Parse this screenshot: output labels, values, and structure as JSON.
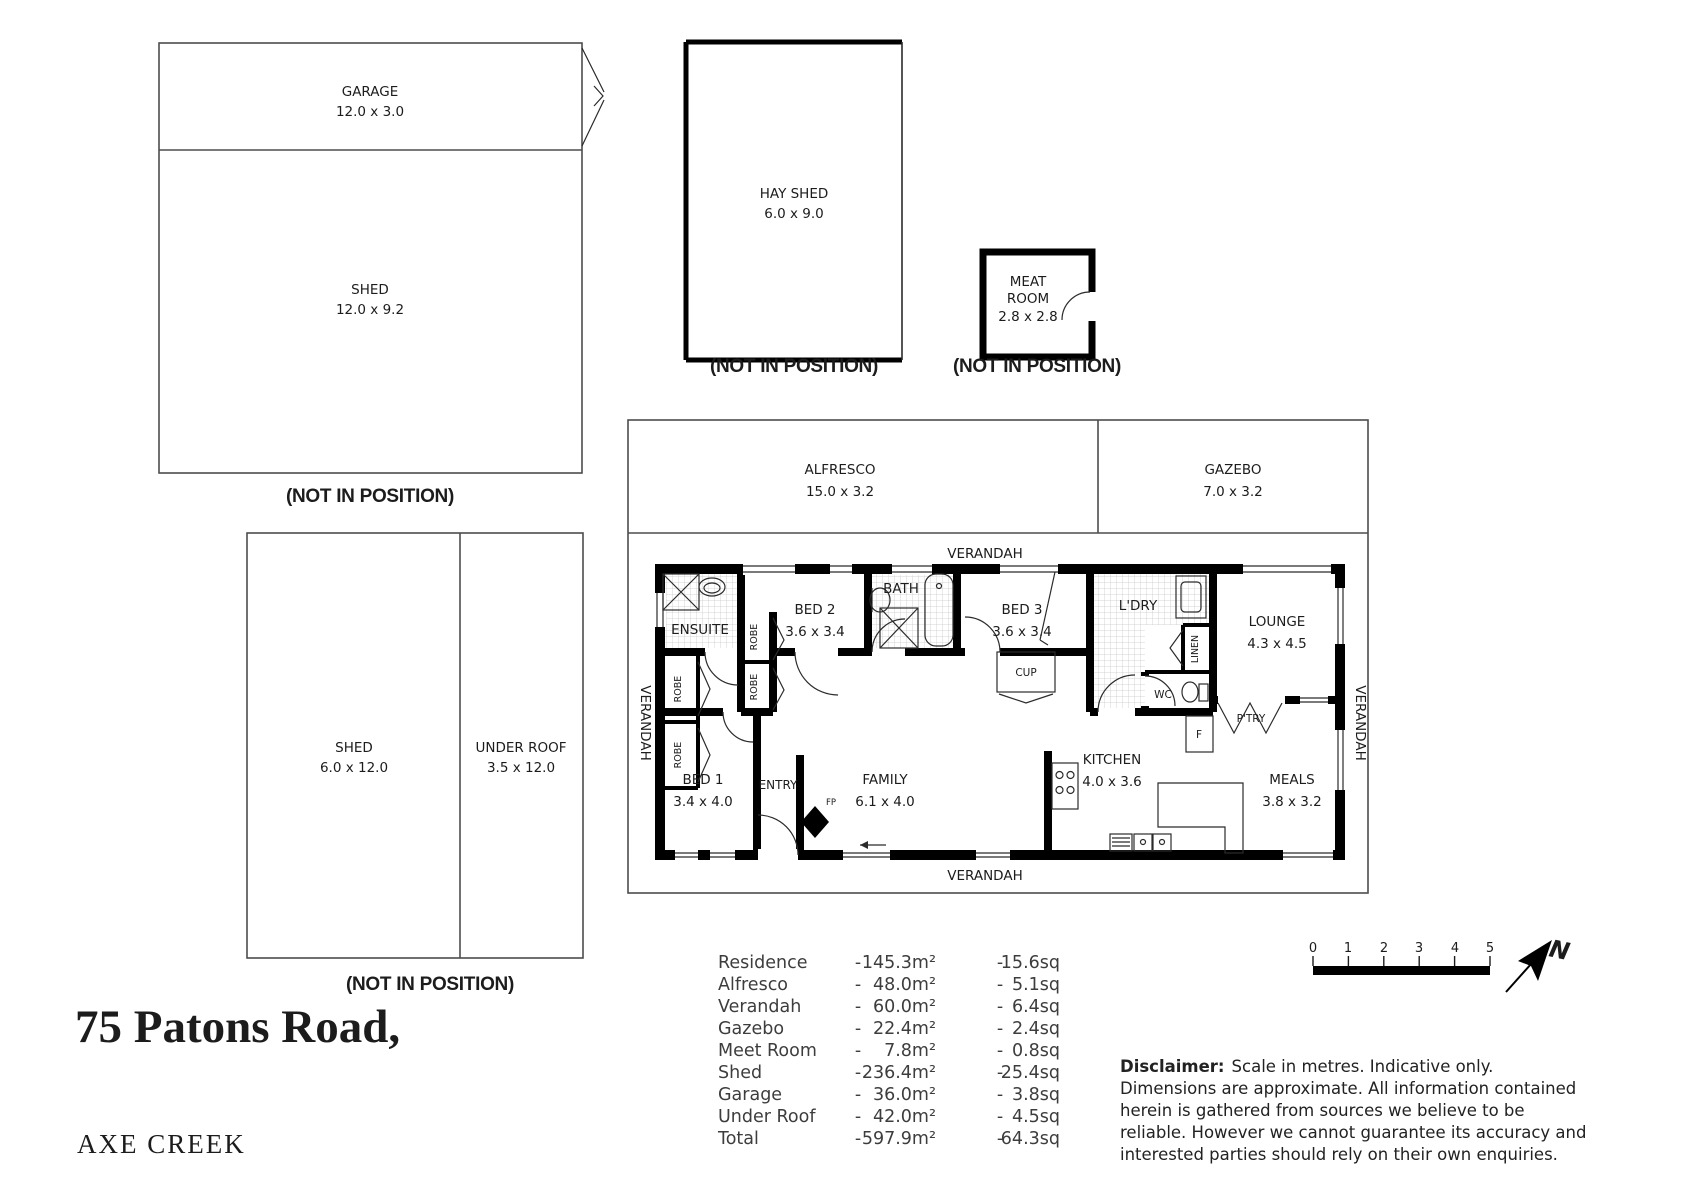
{
  "title": {
    "street": "75 Patons Road,",
    "suburb": "AXE CREEK"
  },
  "not_in_position": "(NOT IN POSITION)",
  "outbuildings": {
    "garage": {
      "name": "GARAGE",
      "dims": "12.0 x 3.0"
    },
    "shed_large": {
      "name": "SHED",
      "dims": "12.0 x 9.2"
    },
    "hay_shed": {
      "name": "HAY SHED",
      "dims": "6.0 x 9.0"
    },
    "meat_room": {
      "name_line1": "MEAT",
      "name_line2": "ROOM",
      "dims": "2.8 x 2.8"
    },
    "shed_small": {
      "name": "SHED",
      "dims": "6.0 x 12.0"
    },
    "under_roof": {
      "name": "UNDER ROOF",
      "dims": "3.5 x 12.0"
    }
  },
  "plan": {
    "alfresco": {
      "name": "ALFRESCO",
      "dims": "15.0 x 3.2"
    },
    "gazebo": {
      "name": "GAZEBO",
      "dims": "7.0 x 3.2"
    },
    "verandah": "VERANDAH",
    "rooms": {
      "ensuite": {
        "name": "ENSUITE"
      },
      "bed2": {
        "name": "BED 2",
        "dims": "3.6 x 3.4"
      },
      "bath": {
        "name": "BATH"
      },
      "bed3": {
        "name": "BED 3",
        "dims": "3.6 x 3.4"
      },
      "ldry": {
        "name": "L'DRY"
      },
      "lounge": {
        "name": "LOUNGE",
        "dims": "4.3 x 4.5"
      },
      "bed1": {
        "name": "BED 1",
        "dims": "3.4 x 4.0"
      },
      "entry": {
        "name": "ENTRY"
      },
      "family": {
        "name": "FAMILY",
        "dims": "6.1 x 4.0"
      },
      "kitchen": {
        "name": "KITCHEN",
        "dims": "4.0 x 3.6"
      },
      "meals": {
        "name": "MEALS",
        "dims": "3.8 x 3.2"
      }
    },
    "fixtures": {
      "robe": "ROBE",
      "linen": "LINEN",
      "wc": "WC",
      "cup": "CUP",
      "fridge": "F",
      "pantry": "P'TRY",
      "fireplace": "FP"
    }
  },
  "areas": {
    "dash": "-",
    "rows": [
      {
        "name": "Residence",
        "m2": "145.3m²",
        "sq": "15.6sq"
      },
      {
        "name": "Alfresco",
        "m2": "48.0m²",
        "sq": "5.1sq"
      },
      {
        "name": "Verandah",
        "m2": "60.0m²",
        "sq": "6.4sq"
      },
      {
        "name": "Gazebo",
        "m2": "22.4m²",
        "sq": "2.4sq"
      },
      {
        "name": "Meet Room",
        "m2": "7.8m²",
        "sq": "0.8sq"
      },
      {
        "name": "Shed",
        "m2": "236.4m²",
        "sq": "25.4sq"
      },
      {
        "name": "Garage",
        "m2": "36.0m²",
        "sq": "3.8sq"
      },
      {
        "name": "Under Roof",
        "m2": "42.0m²",
        "sq": "4.5sq"
      },
      {
        "name": "Total",
        "m2": "597.9m²",
        "sq": "64.3sq"
      }
    ]
  },
  "scalebar": {
    "labels": [
      "0",
      "1",
      "2",
      "3",
      "4",
      "5"
    ],
    "north": "N"
  },
  "disclaimer": {
    "heading": "Disclaimer:",
    "line1": "Scale in metres. Indicative only.",
    "line2": "Dimensions are approximate. All information contained",
    "line3": "herein is gathered from sources we believe to be",
    "line4": "reliable. However we cannot guarantee  its accuracy and",
    "line5": "interested parties should rely on their own enquiries."
  },
  "colors": {
    "wall": "#000000",
    "outline": "#4d4d4d",
    "text": "#1c1c1c"
  }
}
